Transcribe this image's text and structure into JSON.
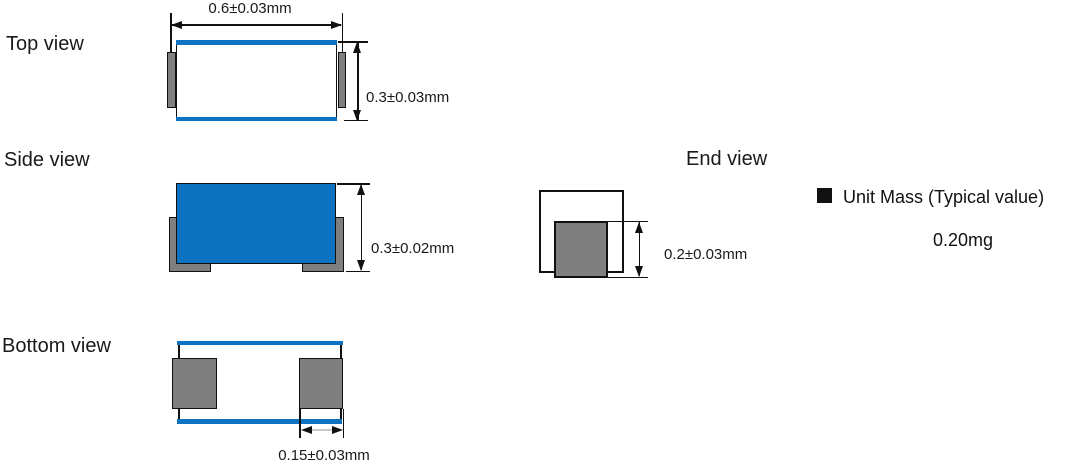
{
  "diagram_title": "Component package dimensions (Top / Side / Bottom / End views)",
  "colors": {
    "body_blue": "#0d72bf",
    "terminal_gray": "#7f7f7f",
    "line_black": "#111111",
    "background": "#ffffff"
  },
  "icons": {
    "unit_mass_bullet": "filled-square"
  },
  "views": {
    "top": {
      "title": "Top view",
      "width_dim": "0.6±0.03mm",
      "height_dim": "0.3±0.03mm"
    },
    "side": {
      "title": "Side view",
      "height_dim": "0.3±0.02mm"
    },
    "end": {
      "title": "End view",
      "terminal_height_dim": "0.2±0.03mm"
    },
    "bottom": {
      "title": "Bottom view",
      "terminal_width_dim": "0.15±0.03mm"
    }
  },
  "unit_mass": {
    "title": "Unit Mass (Typical value)",
    "value": "0.20mg"
  }
}
